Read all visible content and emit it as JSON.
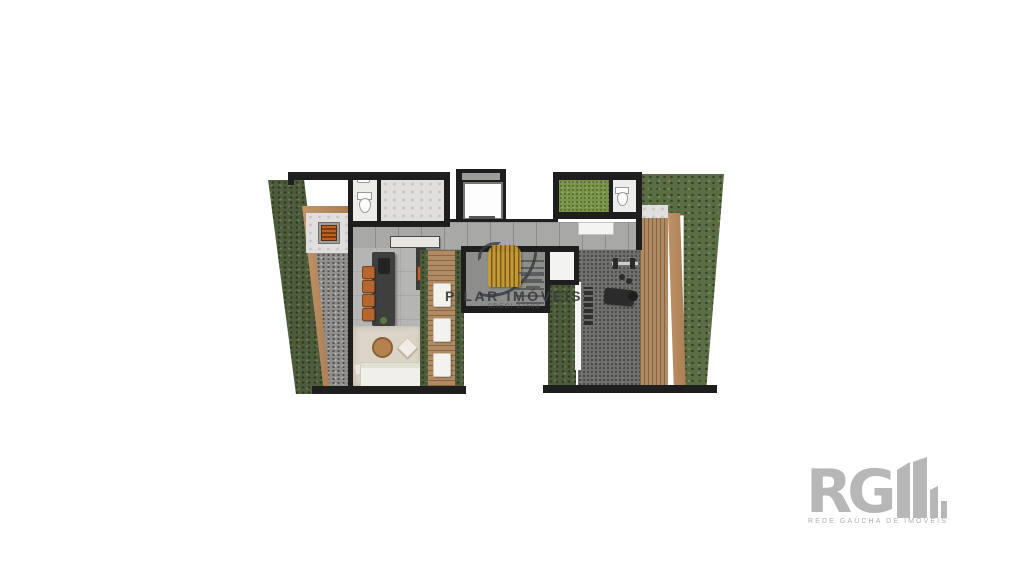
{
  "watermark": {
    "brand": "PILAR IMÓVEIS",
    "creci": "CRECI 27503"
  },
  "agency_logo": {
    "initials": "RG",
    "tagline": "REDE GAÚCHA DE IMÓVEIS"
  },
  "colors": {
    "wall": "#1e1e1e",
    "hedge_green": "#4d5d3b",
    "ivy_green": "#5b6d44",
    "grass_green": "#79944a",
    "gravel": "#918f8b",
    "deck_wood": "#b08a63",
    "corridor_tile": "#a8a8a6",
    "living_floor": "#b5b5b3",
    "gym_floor": "#6e6e6c",
    "rug": "#dbd5c7",
    "stool_orange": "#b5672f",
    "logo_gold": "#c89b31",
    "watermark_text": "#383c40",
    "agency_gray": "#b7b7b7"
  }
}
